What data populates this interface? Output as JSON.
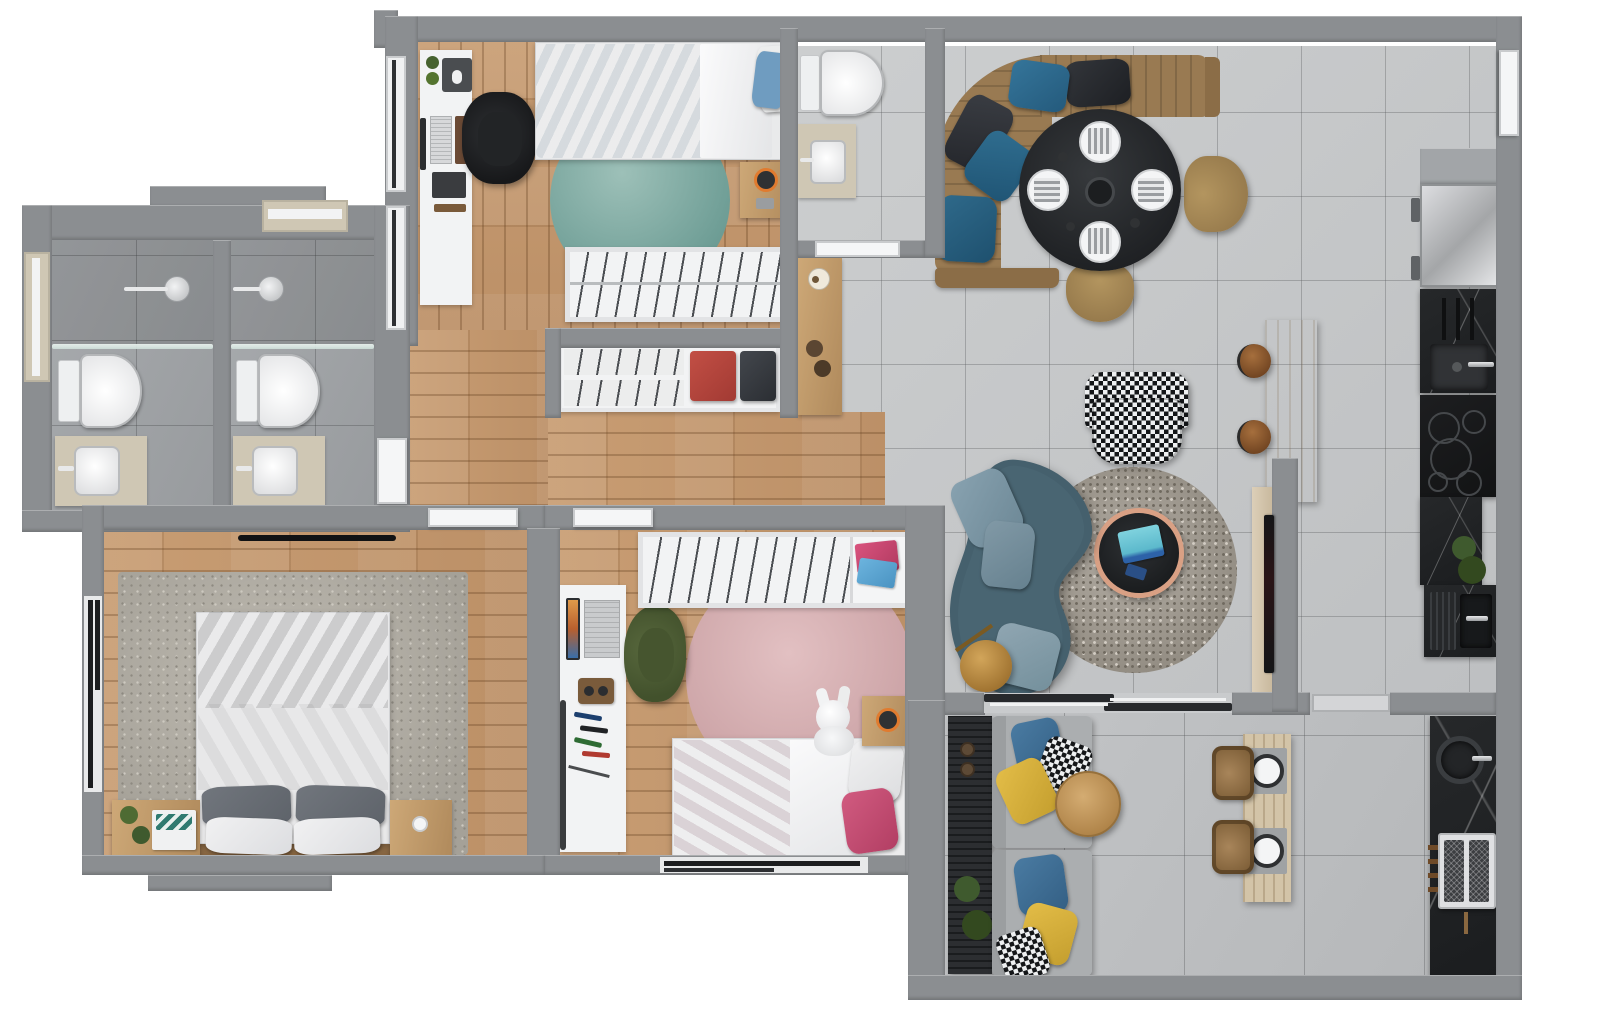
{
  "scene": {
    "kind": "apartment-floor-plan-3d-render",
    "view": "top-down",
    "canvas_w": 1600,
    "canvas_h": 1013,
    "visible_text": "none"
  },
  "palette": {
    "wall": "#8b8e91",
    "wallLight": "#a2a5a8",
    "tile": "#c6c8ca",
    "tileBalcony": "#bcbec0",
    "bathTile": "#a2a5a8",
    "wood": "#c49a70",
    "furnWhite": "#f2f3f4",
    "beige": "#cfc7b4",
    "bedBlue": "#8cb3d3",
    "pillowBlueLight": "#6f9cc0",
    "rugTeal": "#76a39a",
    "sofaBrown": "#997a52",
    "pillowPetrol": "#2c6886",
    "pillowBlack": "#26282c",
    "tableBlack": "#25272a",
    "chairTan": "#a88a5c",
    "rugSpeckleGray": "#a59f96",
    "tableCopper": "#d9a084",
    "tabletTeal": "#6fc8da",
    "sofaBlue": "#45606d",
    "sofaBluePillow": "#7d97a5",
    "lampGold": "#b08341",
    "islandWood": "#ddd1bc",
    "stoolBrown": "#8f5c31",
    "counterBlack": "#212325",
    "fridgeSilverA": "#d9dadc",
    "fridgeSilverB": "#a7a9ab",
    "duvetGray": "#5a5f66",
    "rugMasterGray": "#b3afa6",
    "nightstandWood": "#b99268",
    "plantGreen": "#46622f",
    "duvetPink": "#c25674",
    "pillowPink": "#c9486f",
    "rugPink": "#d6aeb0",
    "chairGreen": "#4d5c35",
    "balconySofaGray": "#abaeb0",
    "pillowYellow": "#d9b23c",
    "pillowBlue": "#3e6e95",
    "benchBlack": "#2c2e31",
    "outdoorTableWood": "#d3c4a8",
    "wicker": "#97754b",
    "doorWhite": "#f5f6f7",
    "clothesRed": "#b5433d",
    "clothesDark": "#35383d",
    "speakerOrange": "#e07b2f",
    "laptopScreen": "#d98a3c"
  },
  "rooms": [
    {
      "id": "bathroom-1",
      "name": "Bathroom 1",
      "floor": "gray tile",
      "fixtures": [
        "walk-in shower",
        "toilet",
        "vanity sink"
      ]
    },
    {
      "id": "bathroom-2",
      "name": "Bathroom 2",
      "floor": "gray tile",
      "fixtures": [
        "walk-in shower",
        "toilet",
        "vanity sink"
      ]
    },
    {
      "id": "bedroom-blue",
      "name": "Bedroom with blue bed",
      "floor": "wood",
      "fixtures": [
        "single bed with blue duvet",
        "desk with monitor and keyboard",
        "black office chair",
        "round teal rug",
        "nightstand with orange speaker",
        "open wardrobe with hangers"
      ]
    },
    {
      "id": "guest-wc",
      "name": "Guest WC",
      "floor": "gray tile",
      "fixtures": [
        "toilet",
        "vanity sink"
      ]
    },
    {
      "id": "hallway",
      "name": "Hallway",
      "floor": "wood",
      "fixtures": [
        "open closet with hangers and red and black folded clothes",
        "console table with candle"
      ]
    },
    {
      "id": "living-dining",
      "name": "Living / Dining room",
      "floor": "gray tile",
      "fixtures": [
        "curved brown corner sofa with petrol and black cushions",
        "round black dining table set for four",
        "two tan dining chairs",
        "houndstooth armchair",
        "round speckled gray rug",
        "round black coffee table with copper rim and tablet",
        "curved blue velvet sofa",
        "gold floor lamp",
        "wood media panel with TV",
        "kitchen island with two leather stools",
        "console with candle"
      ]
    },
    {
      "id": "kitchen",
      "name": "Kitchen",
      "floor": "gray tile",
      "fixtures": [
        "stainless fridge",
        "black counter with utensil rail and square sink",
        "induction cooktop with five zones",
        "black marble counter with plant",
        "sink with drainboard"
      ]
    },
    {
      "id": "master-bedroom",
      "name": "Master bedroom",
      "floor": "wood",
      "fixtures": [
        "double bed with gray duvet and four pillows",
        "large gray rug",
        "two wooden nightstands",
        "plants and books",
        "window"
      ]
    },
    {
      "id": "kids-bedroom",
      "name": "Kids bedroom",
      "floor": "wood",
      "fixtures": [
        "single bed with pink duvet",
        "round pink rug",
        "white desk with laptop and markers",
        "green chair",
        "wardrobe with hangers and folded clothes",
        "plush bunny",
        "nightstand with orange speaker",
        "window"
      ]
    },
    {
      "id": "balcony",
      "name": "Balcony terrace",
      "floor": "large gray tile",
      "fixtures": [
        "gray outdoor sofa with blue yellow and houndstooth cushions",
        "black slatted bench with plants",
        "round wooden coffee table",
        "plank dining table set for two",
        "two wicker chairs",
        "outdoor black marble counter with round sink",
        "barbecue grill"
      ]
    }
  ],
  "doors": [
    "entrance door (right wall)",
    "sliding glass door to balcony",
    "balcony service door",
    "guest WC door",
    "master bedroom door",
    "kids bedroom door",
    "bathroom door"
  ],
  "windows": [
    "bedroom left wall x2",
    "bathroom left",
    "bathroom top",
    "master bedroom left",
    "kids bedroom bottom"
  ]
}
